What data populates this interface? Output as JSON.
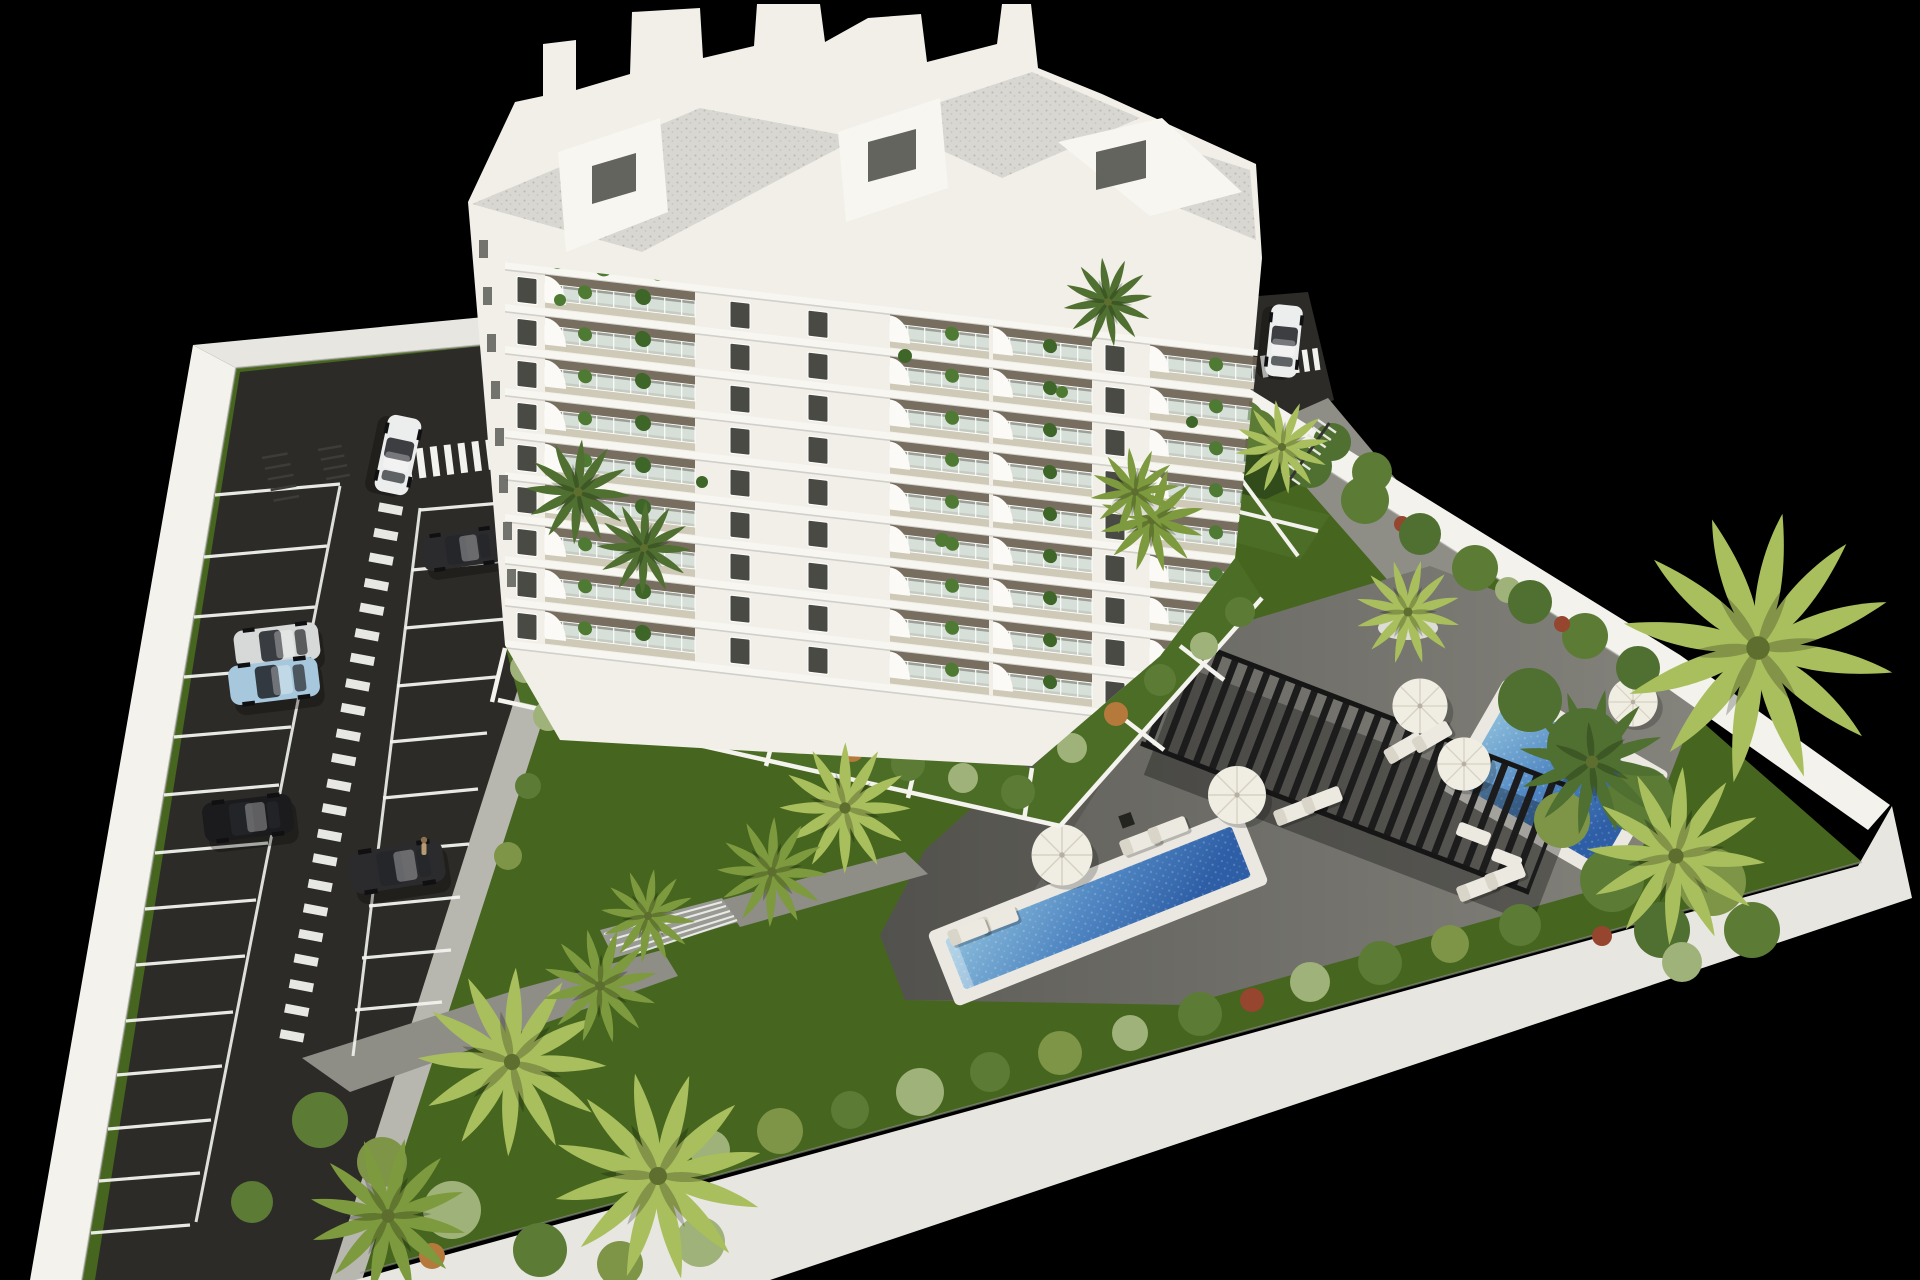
{
  "meta": {
    "type": "3d-architectural-render",
    "description": "Aerial 3D visualization of a new white multi-storey apartment residence on a walled plot shown against a pure black background. Left: asphalt parking lot with white stall markings, crossings and parked cars. Center: white apartment tower with plant-filled balconies, roof terraces and penthouses. Right/bottom: landscaped garden with lawn, palm trees, hedges, grey pool deck, black slatted pergola, white parasols, sun loungers and two blue swimming pools."
  },
  "colors": {
    "bg": "#000000",
    "lawn": "#46651f",
    "lawnShade": "#2e471a",
    "gardenGrass": "#4c6d26",
    "asphalt": "#2d2b28",
    "road": "#8e8d86",
    "walk": "#b7b6af",
    "wall": "#e7e6e1",
    "wallBright": "#f3f2ed",
    "wallShade": "#c9c8c2",
    "facade": "#f1efe8",
    "phWhite": "#f7f6f1",
    "roofCol": "#d8d7d1",
    "windowDark": "#4a4a44",
    "balconyWall": "#6e6354",
    "balconyFloor": "#cfc9b8",
    "glassCol": "#bed0c9",
    "coping": "#eae8e1",
    "pergolaCol": "#1c1c1c",
    "umbrellaCol": "#f0ede3",
    "loungerCol": "#ece9e0",
    "lineWhite": "#f2f2ef",
    "plantGreen": "#4e7a33",
    "bushGreen": "#5c7c36",
    "bushSage": "#9fb279",
    "bushOlive": "#7e9447",
    "bushOrange": "#b5793c",
    "bushRed": "#96452e",
    "palmLight": "#a9bf5d",
    "palmMid": "#7d9a3e",
    "palmDark": "#4f7030",
    "carWhite": "#eceded",
    "carSilver": "#d7d8d8",
    "carBlue": "#a7c7dd",
    "carDark1": "#1b1b1e",
    "carDark2": "#2b2b2e",
    "waterDeep": "#2e5ea6",
    "waterLight": "#8fc0dc"
  },
  "scene": {
    "site": {
      "label": "walled residential plot",
      "perimeter": "white concrete walls on all four sides",
      "background": "solid black"
    },
    "building": {
      "label": "white apartment tower",
      "visible_floors": 9,
      "features": [
        "penthouse volumes and chimneys on roof",
        "grey gravel roof terraces",
        "stacked balconies with glass railings",
        "potted plants on balconies",
        "white quarter-round awnings",
        "small dark windows",
        "private walled gardens at base"
      ]
    },
    "parking": {
      "label": "outdoor parking lot",
      "surface": "dark asphalt",
      "stall_rows": 2,
      "markings": [
        "white stall lines",
        "central dashed pedestrian lane",
        "zebra crossing at entrance",
        "zebra crossing at rear lane"
      ],
      "bike_racks": 3,
      "cars": [
        {
          "color": "white",
          "state": "driving near entrance"
        },
        {
          "color": "dark-grey",
          "location": "upper right row"
        },
        {
          "color": "silver",
          "location": "middle left row"
        },
        {
          "color": "light-blue",
          "location": "middle left row"
        },
        {
          "color": "black",
          "location": "lower left row"
        },
        {
          "color": "black",
          "location": "lower right row"
        },
        {
          "color": "white",
          "location": "rear lane behind building"
        }
      ]
    },
    "amenities": {
      "pools": [
        {
          "label": "main lap pool",
          "shape": "long rectangle",
          "water": "blue gradient"
        },
        {
          "label": "upper garden pool",
          "shape": "rectangle",
          "water": "blue gradient"
        }
      ],
      "pergola": {
        "label": "black slatted pergola",
        "count": 1
      },
      "parasols": 5,
      "sun_loungers": 10,
      "stairs": "concrete garden steps",
      "paths": "grey concrete paths connecting lawn, deck and rear lane"
    },
    "landscape": {
      "lawn": "large green lawn",
      "palm_trees": "palm clusters at bottom-left corner, along walls, on lawn and a large overhanging palm group on the right",
      "hedges": "mixed green, sage and orange shrubs along walls, deck and building base",
      "planters": "round white planters with palms"
    }
  }
}
